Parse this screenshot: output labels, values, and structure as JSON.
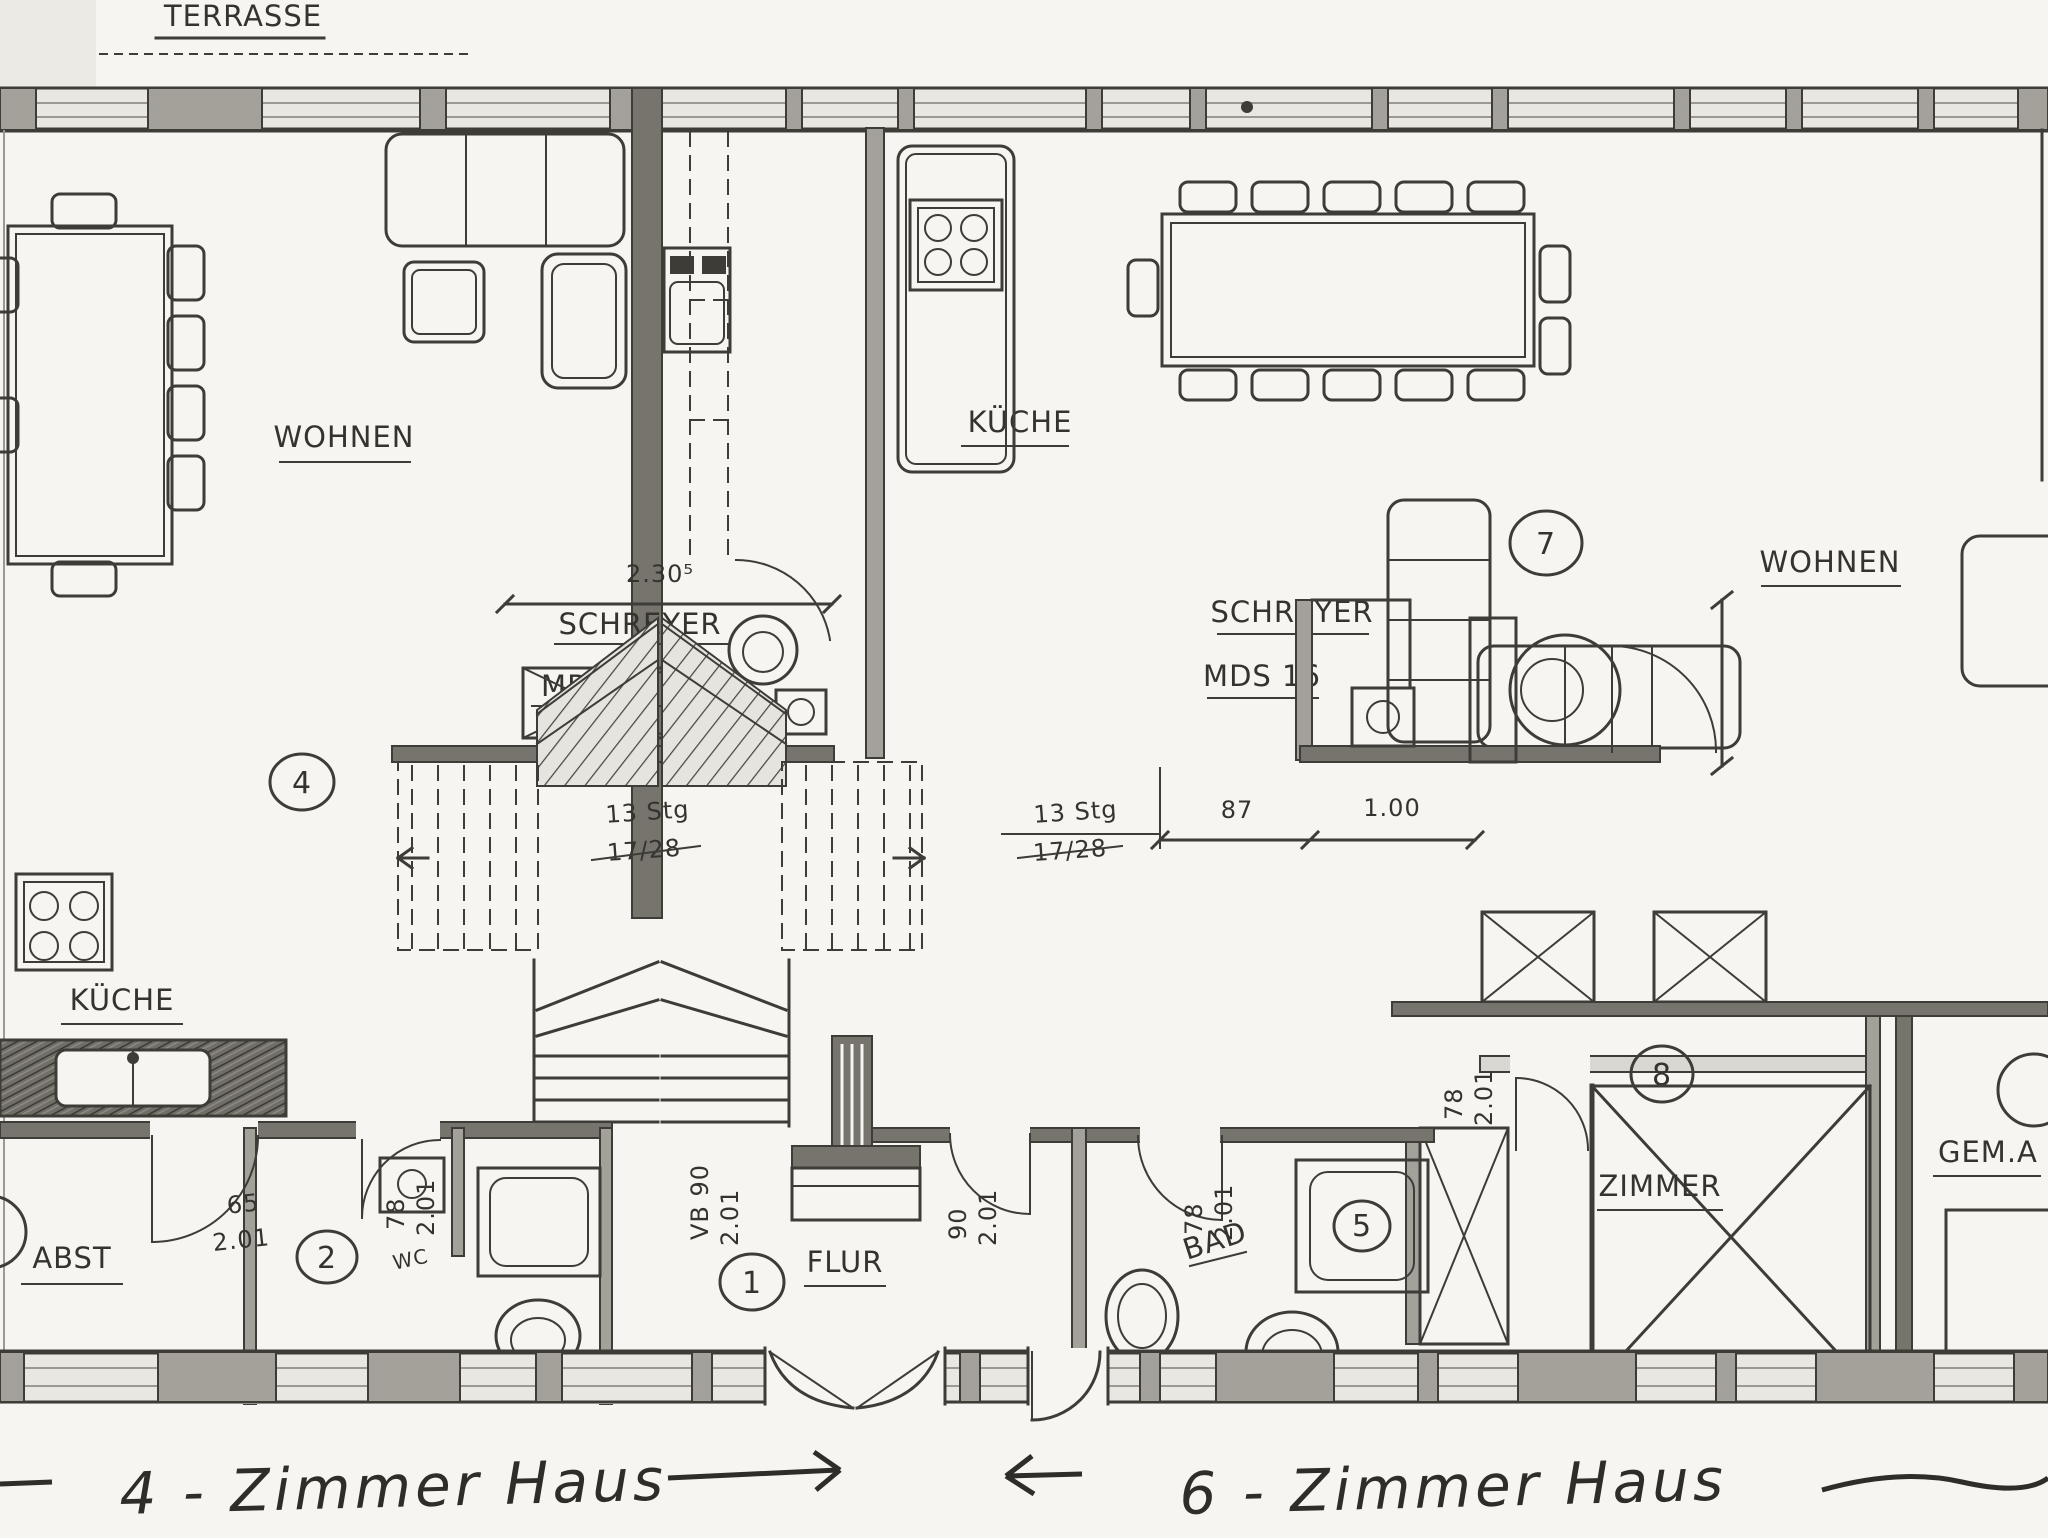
{
  "labels": {
    "terrasse": "TERRASSE",
    "wohnen_left": "WOHNEN",
    "wohnen_right": "WOHNEN",
    "kueche_mid": "KÜCHE",
    "kueche_left": "KÜCHE",
    "abst": "ABST",
    "flur": "FLUR",
    "bad": "BAD",
    "wc": "WC",
    "zimmer": "ZIMMER",
    "gem": "GEM.A",
    "schreyer1_line1": "SCHREYER",
    "schreyer1_line2": "MDS 28",
    "schreyer2_line1": "SCHREYER",
    "schreyer2_line2": "MDS 16"
  },
  "stairs": {
    "left_line1": "13 Stg",
    "left_line2": "17/28",
    "right_line1": "13 Stg",
    "right_line2": "17/28"
  },
  "dims": {
    "span": "2.30⁵",
    "d87": "87",
    "d100": "1.00",
    "abst_w": "65",
    "abst_h": "2.01",
    "bath_w": "78",
    "bath_h": "2.01",
    "flur_w": "VB 90",
    "flur_h": "2.01",
    "hall_w": "90",
    "hall_h": "2.01",
    "bad_w": "78",
    "bad_h": "2.01",
    "zimmer_w": "78",
    "zimmer_h": "2.01"
  },
  "circles": {
    "c1": "1",
    "c2": "2",
    "c4": "4",
    "c5": "5",
    "c7": "7",
    "c8": "8"
  },
  "captions": {
    "left": "4 - Zimmer Haus",
    "right": "6 - Zimmer Haus"
  }
}
